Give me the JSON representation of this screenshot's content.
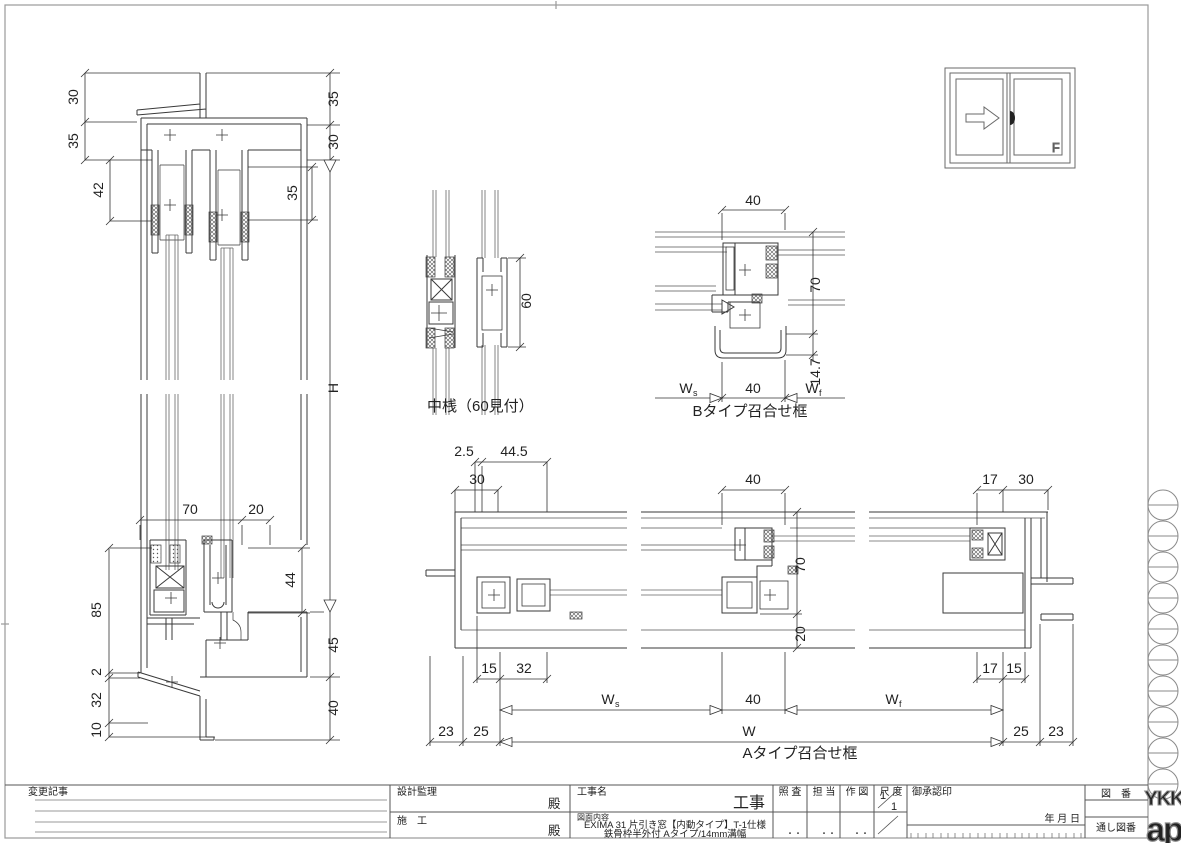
{
  "sheet": {
    "bg": "#ffffff",
    "line_color": "#3a3a3a",
    "border_color": "#9a9a9a"
  },
  "window_icon": {
    "fixed_label": "F"
  },
  "vertical_section": {
    "dims": {
      "d30_tl": "30",
      "d35_l": "35",
      "d42": "42",
      "d35_tr": "35",
      "d30_r": "30",
      "d35_inner": "35",
      "height": "H",
      "d70": "70",
      "d20": "20",
      "d85": "85",
      "d44": "44",
      "d2": "2",
      "d32": "32",
      "d10": "10",
      "d45": "45",
      "d40": "40"
    }
  },
  "nakazan_section": {
    "label": "中桟（60見付）",
    "d60": "60"
  },
  "btype_section": {
    "label": "Bタイプ召合せ框",
    "d40_top": "40",
    "d70": "70",
    "d14_7": "14.7",
    "w_s": "W",
    "w_s_sub": "s",
    "d40_bottom": "40",
    "w_f": "W",
    "w_f_sub": "f"
  },
  "atype_section": {
    "label": "Aタイプ召合せ框",
    "d2_5": "2.5",
    "d44_5": "44.5",
    "d30_left": "30",
    "d40_top": "40",
    "d17_tr": "17",
    "d30_tr": "30",
    "d70": "70",
    "d20": "20",
    "d15_bl": "15",
    "d32_bl": "32",
    "d17_br": "17",
    "d15_br": "15",
    "w_s": "W",
    "w_s_sub": "s",
    "d40_bottom": "40",
    "w_f": "W",
    "w_f_sub": "f",
    "w_total": "W",
    "d23_left": "23",
    "d25_left": "25",
    "d25_right": "25",
    "d23_right": "23"
  },
  "title_block": {
    "henkou_kiji": "変更記事",
    "sekkei_kanri": "設計監理",
    "dono_1": "殿",
    "sekou": "施　工",
    "dono_2": "殿",
    "kouji_mei": "工事名",
    "kouji": "工事",
    "zumen_naiyou": "図面内容",
    "naiyou_line1": "EXIMA 31 片引き窓【内動タイプ】T-1仕様",
    "naiyou_line2": "鉄骨枠半外付 Aタイプ/14mm溝幅",
    "shousa": "照 査",
    "tantou": "担 当",
    "sakuzu": "作 図",
    "shakudo": "尺 度",
    "scale_num": "1",
    "scale_den": "1",
    "goshounin_in": "御承認印",
    "nen_gappi": "年 月 日",
    "zuban": "図　番",
    "tooshi_zuban": "通し図番",
    "sign_dots": "・・"
  },
  "logo": {
    "ykk": "YKK",
    "ap": "ap"
  }
}
